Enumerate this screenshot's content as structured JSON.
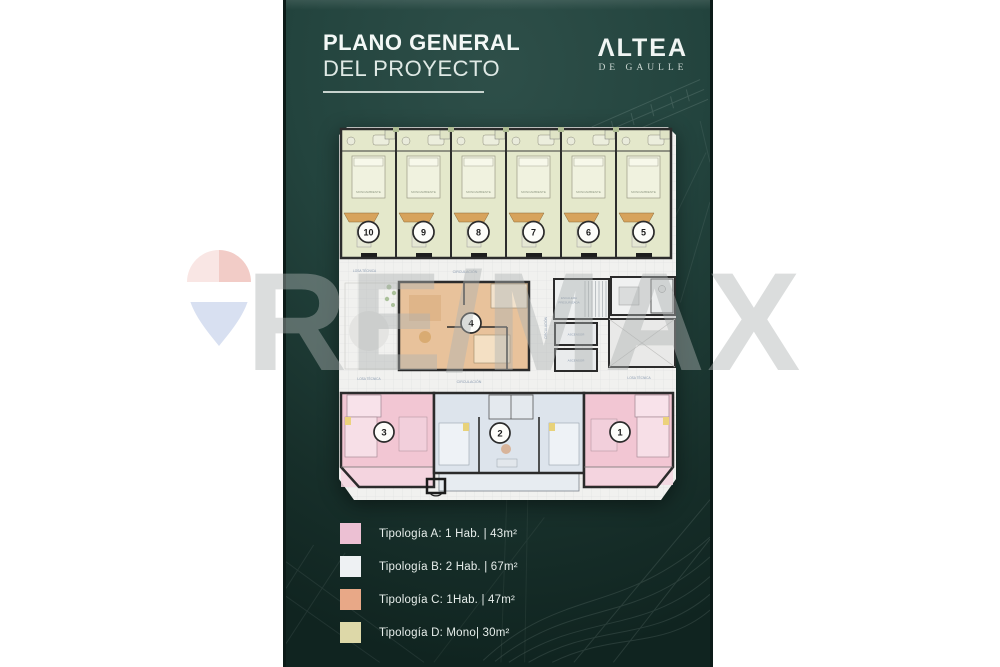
{
  "header": {
    "title_line1": "PLANO GENERAL",
    "title_line2": "DEL PROYECTO"
  },
  "logo": {
    "name": "ΛLTEA",
    "subtitle": "DE GAULLE"
  },
  "watermark": {
    "text": "RE/MAX",
    "balloon_red": "#e9a49b",
    "balloon_blue": "#b9c7e6"
  },
  "legend": {
    "items": [
      {
        "label": "Tipología A: 1 Hab.  |  43m²",
        "color": "#ecc0d3"
      },
      {
        "label": "Tipología B: 2 Hab.  |  67m²",
        "color": "#eef1f3"
      },
      {
        "label": "Tipología C: 1Hab.  |  47m²",
        "color": "#e8a887"
      },
      {
        "label": "Tipología D: Mono|  30m²",
        "color": "#ddd8a8"
      }
    ]
  },
  "floor_plan": {
    "unit_numbers": {
      "top": [
        "10",
        "9",
        "8",
        "7",
        "6",
        "5"
      ],
      "middle": "4",
      "bottom": [
        "3",
        "2",
        "1"
      ]
    },
    "labels": {
      "circulacion": "CIRCULACIÓN",
      "losa_tecnica": "LOSA TÉCNICA",
      "escalera_line1": "ESCALERA",
      "escalera_line2": "PRESURIZADA",
      "ascensor": "ASCENSOR",
      "monoambiente": "MONOAMBIENTE"
    },
    "typology_colors": {
      "a": "#f2c6d3",
      "b": "#dde4ec",
      "c": "#e8c29b",
      "d": "#e4e8cb"
    }
  }
}
